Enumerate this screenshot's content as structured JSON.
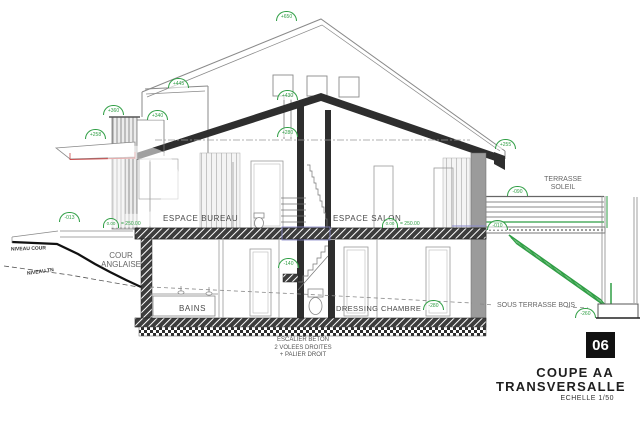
{
  "drawing": {
    "sheet_number": "06",
    "title_line1": "COUPE  AA",
    "title_line2": "TRANSVERSALLE",
    "scale": "ECHELLE 1/50",
    "colors": {
      "annotation_green": "#2f9e44",
      "linework_dark": "#2e2e2e"
    }
  },
  "rooms": {
    "bureau": "ESPACE BUREAU",
    "salon": "ESPACE SALON",
    "bains": "BAINS",
    "dressing": "DRESSING",
    "chambre": "CHAMBRE"
  },
  "site_labels": {
    "niveau_cour": "NIVEAU COUR",
    "niveau_tn": "NIVEAU TN",
    "cour_anglaise_line1": "COUR",
    "cour_anglaise_line2": "ANGLAISE",
    "terrasse_line1": "TERRASSE",
    "terrasse_line2": "SOLEIL",
    "sous_terrasse": "SOUS TERRASSE BOIS"
  },
  "notes": {
    "stair_line1": "ESCALIER BETON",
    "stair_line2": "2 VOLEES DROITES",
    "stair_line3": "+ PALIER DROIT"
  },
  "levels": {
    "ridge": "+650",
    "left_wing": "+445",
    "roof_peak": "+430",
    "parapet": "+360",
    "parapet_step": "+340",
    "canopy": "+258",
    "ceiling": "+280",
    "right_eave": "+255",
    "cour": "-013",
    "floor_zero_left": "0.00",
    "floor_zero_left_suffix": "= 250.00",
    "floor_zero_right": "0.00",
    "floor_zero_right_suffix": "= 250.00",
    "terrace_slab": "-010",
    "terrace_deck": "-090",
    "stair_landing": "-140",
    "basement_floor": "-280",
    "garden_stair_foot": "-260"
  }
}
